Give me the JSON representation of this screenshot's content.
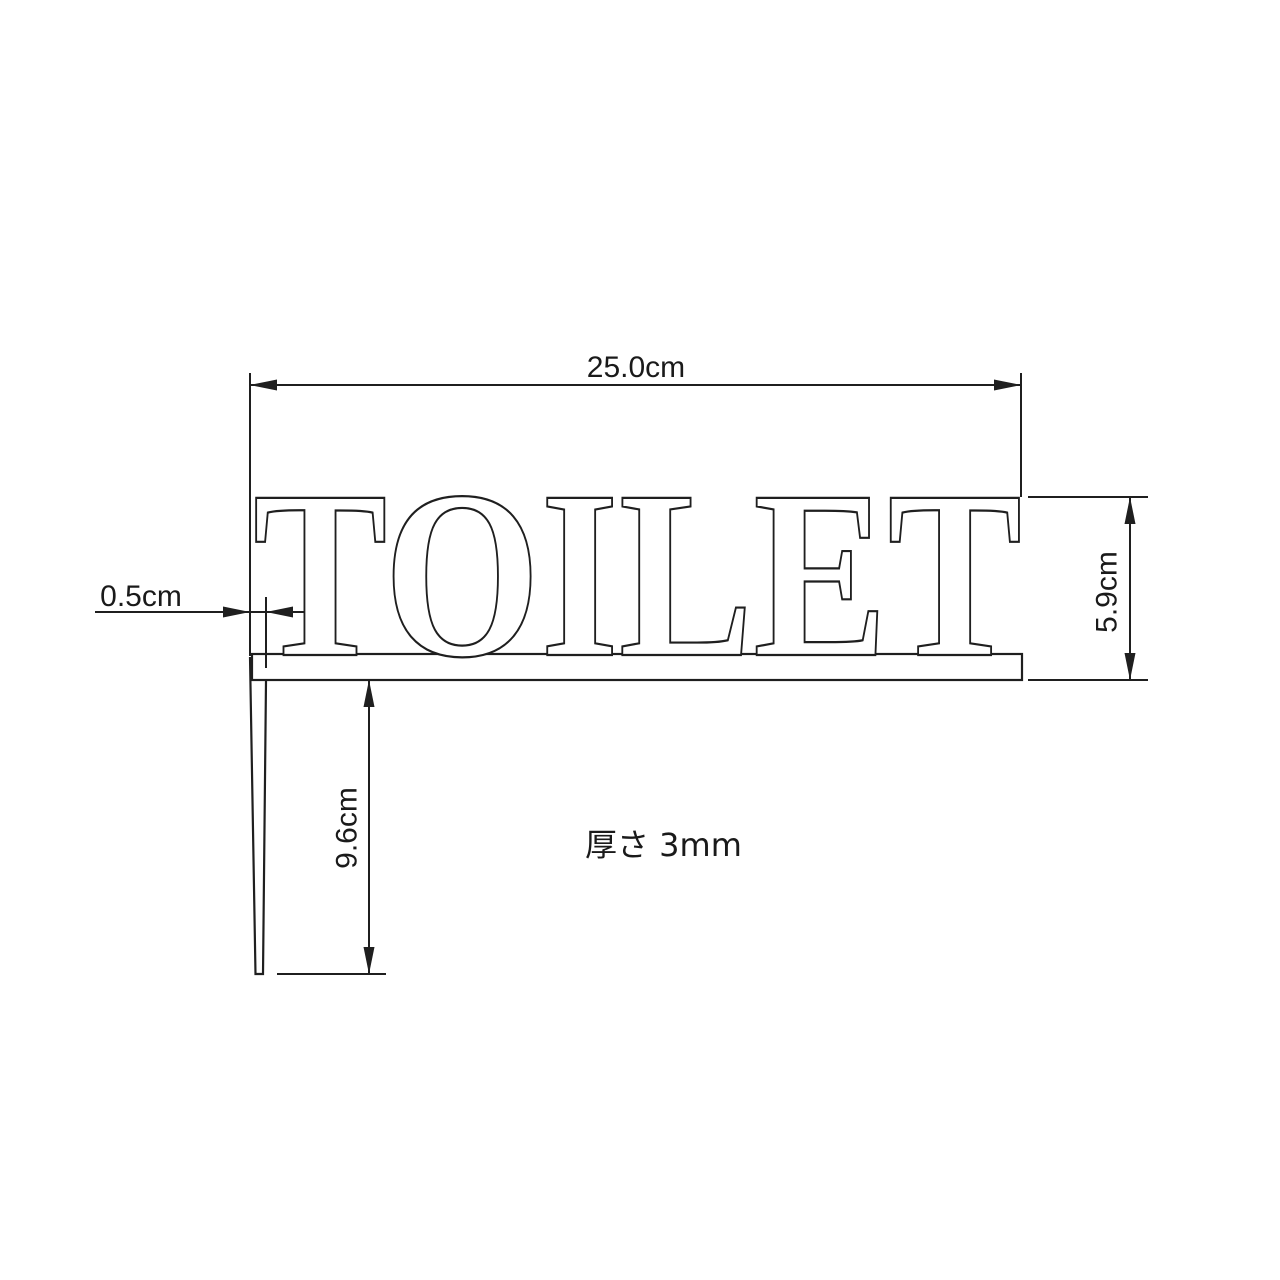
{
  "drawing": {
    "sign_text": "TOILET",
    "thickness_note": "厚さ 3mm",
    "dimensions": {
      "width": "25.0cm",
      "height": "5.9cm",
      "leg_width": "0.5cm",
      "leg_length": "9.6cm"
    },
    "colors": {
      "line": "#1f1f1f",
      "text": "#1a1a1a",
      "background": "#ffffff",
      "letter_fill": "#ffffff"
    }
  }
}
